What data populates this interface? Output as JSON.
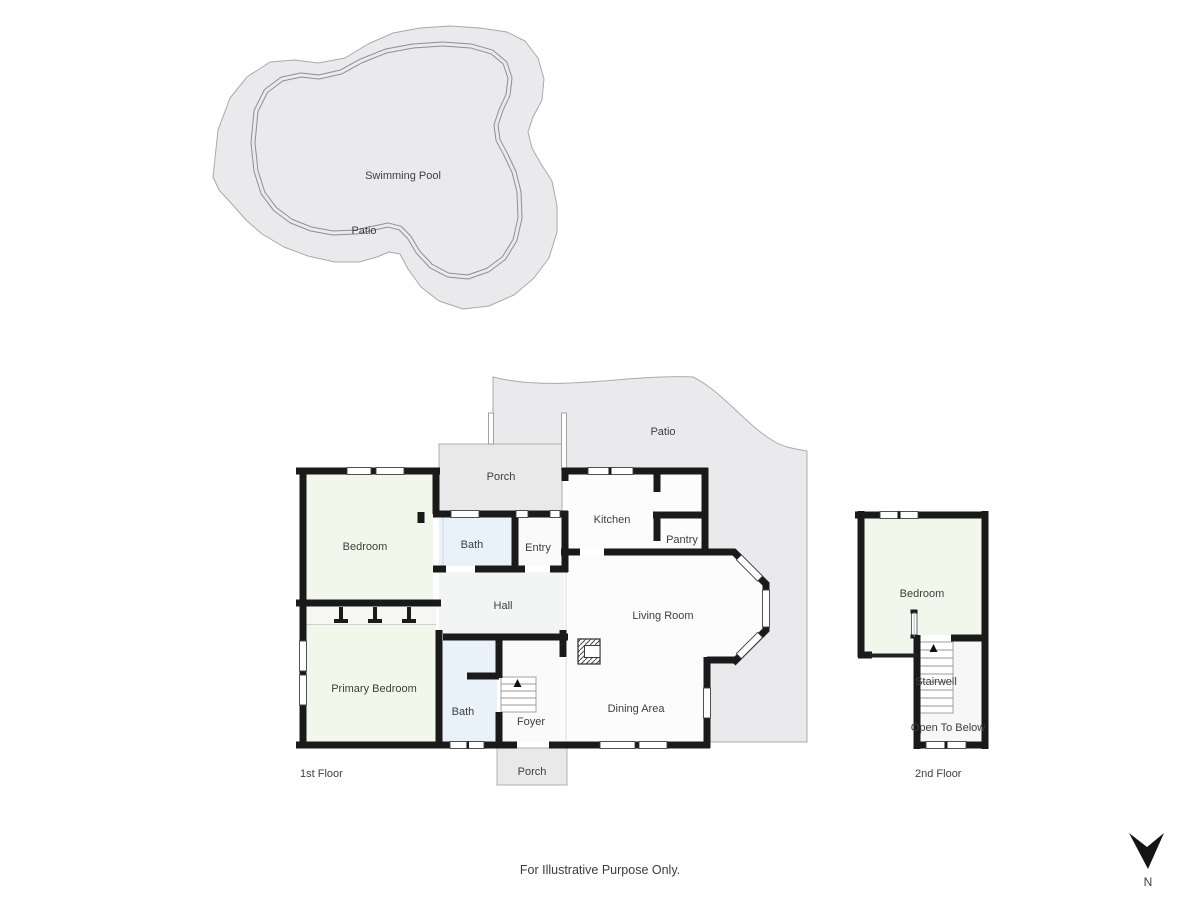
{
  "colors": {
    "wall": "#1a1a1a",
    "bedroom_fill": "#f1f7eb",
    "bath_fill": "#e9f2f9",
    "patio_fill": "#eaeaec",
    "porch_fill": "#e9e9ea",
    "hall_fill": "#f3f4f4",
    "room_fill": "#fcfcfc",
    "foyer_fill": "#fafafa",
    "open_below_fill": "#f7f7f7",
    "label_text": "#3e3e3e"
  },
  "site": {
    "swimming_pool_label": "Swimming Pool",
    "patio_label": "Patio"
  },
  "first_floor": {
    "caption": "1st Floor",
    "patio_label": "Patio",
    "porch_top_label": "Porch",
    "porch_bottom_label": "Porch",
    "rooms": {
      "bedroom": "Bedroom",
      "bath_top": "Bath",
      "entry": "Entry",
      "kitchen": "Kitchen",
      "pantry": "Pantry",
      "hall": "Hall",
      "living_room": "Living Room",
      "primary_bedroom": "Primary Bedroom",
      "bath_bottom": "Bath",
      "foyer": "Foyer",
      "dining_area": "Dining Area"
    }
  },
  "second_floor": {
    "caption": "2nd Floor",
    "rooms": {
      "bedroom": "Bedroom",
      "stairwell": "Stairwell",
      "open_to_below": "Open To Below"
    }
  },
  "footer": {
    "disclaimer": "For Illustrative Purpose Only."
  },
  "compass": {
    "north_label": "N"
  }
}
